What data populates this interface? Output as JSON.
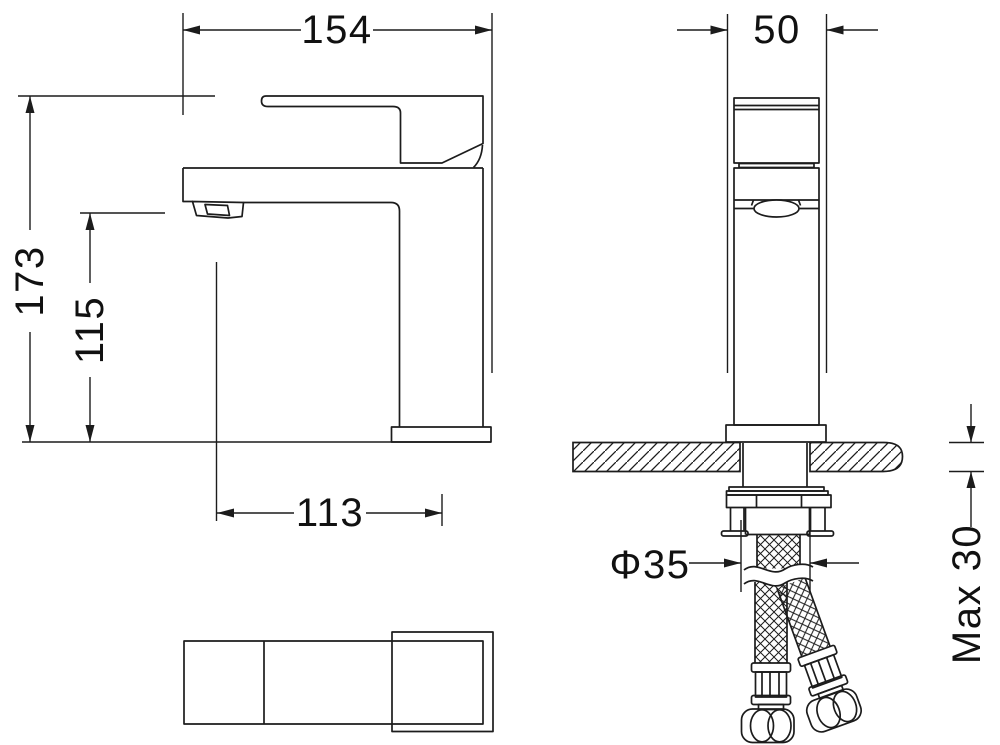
{
  "drawing": {
    "type": "technical-dimension-drawing",
    "subject": "single-lever basin mixer faucet, side view, front view, top view, mounting hardware with braided supply hoses",
    "colors": {
      "line": "#1c1c1c",
      "background": "#ffffff",
      "text": "#111111"
    },
    "views": [
      "side-view",
      "front-view",
      "top-view",
      "deck-section-with-hoses"
    ]
  },
  "dimensions": {
    "overall_projection": "154",
    "body_width": "50",
    "overall_height": "173",
    "spout_height": "115",
    "spout_center_reach": "113",
    "mounting_hole_diameter": "Φ35",
    "max_deck_thickness": "Max 30"
  }
}
